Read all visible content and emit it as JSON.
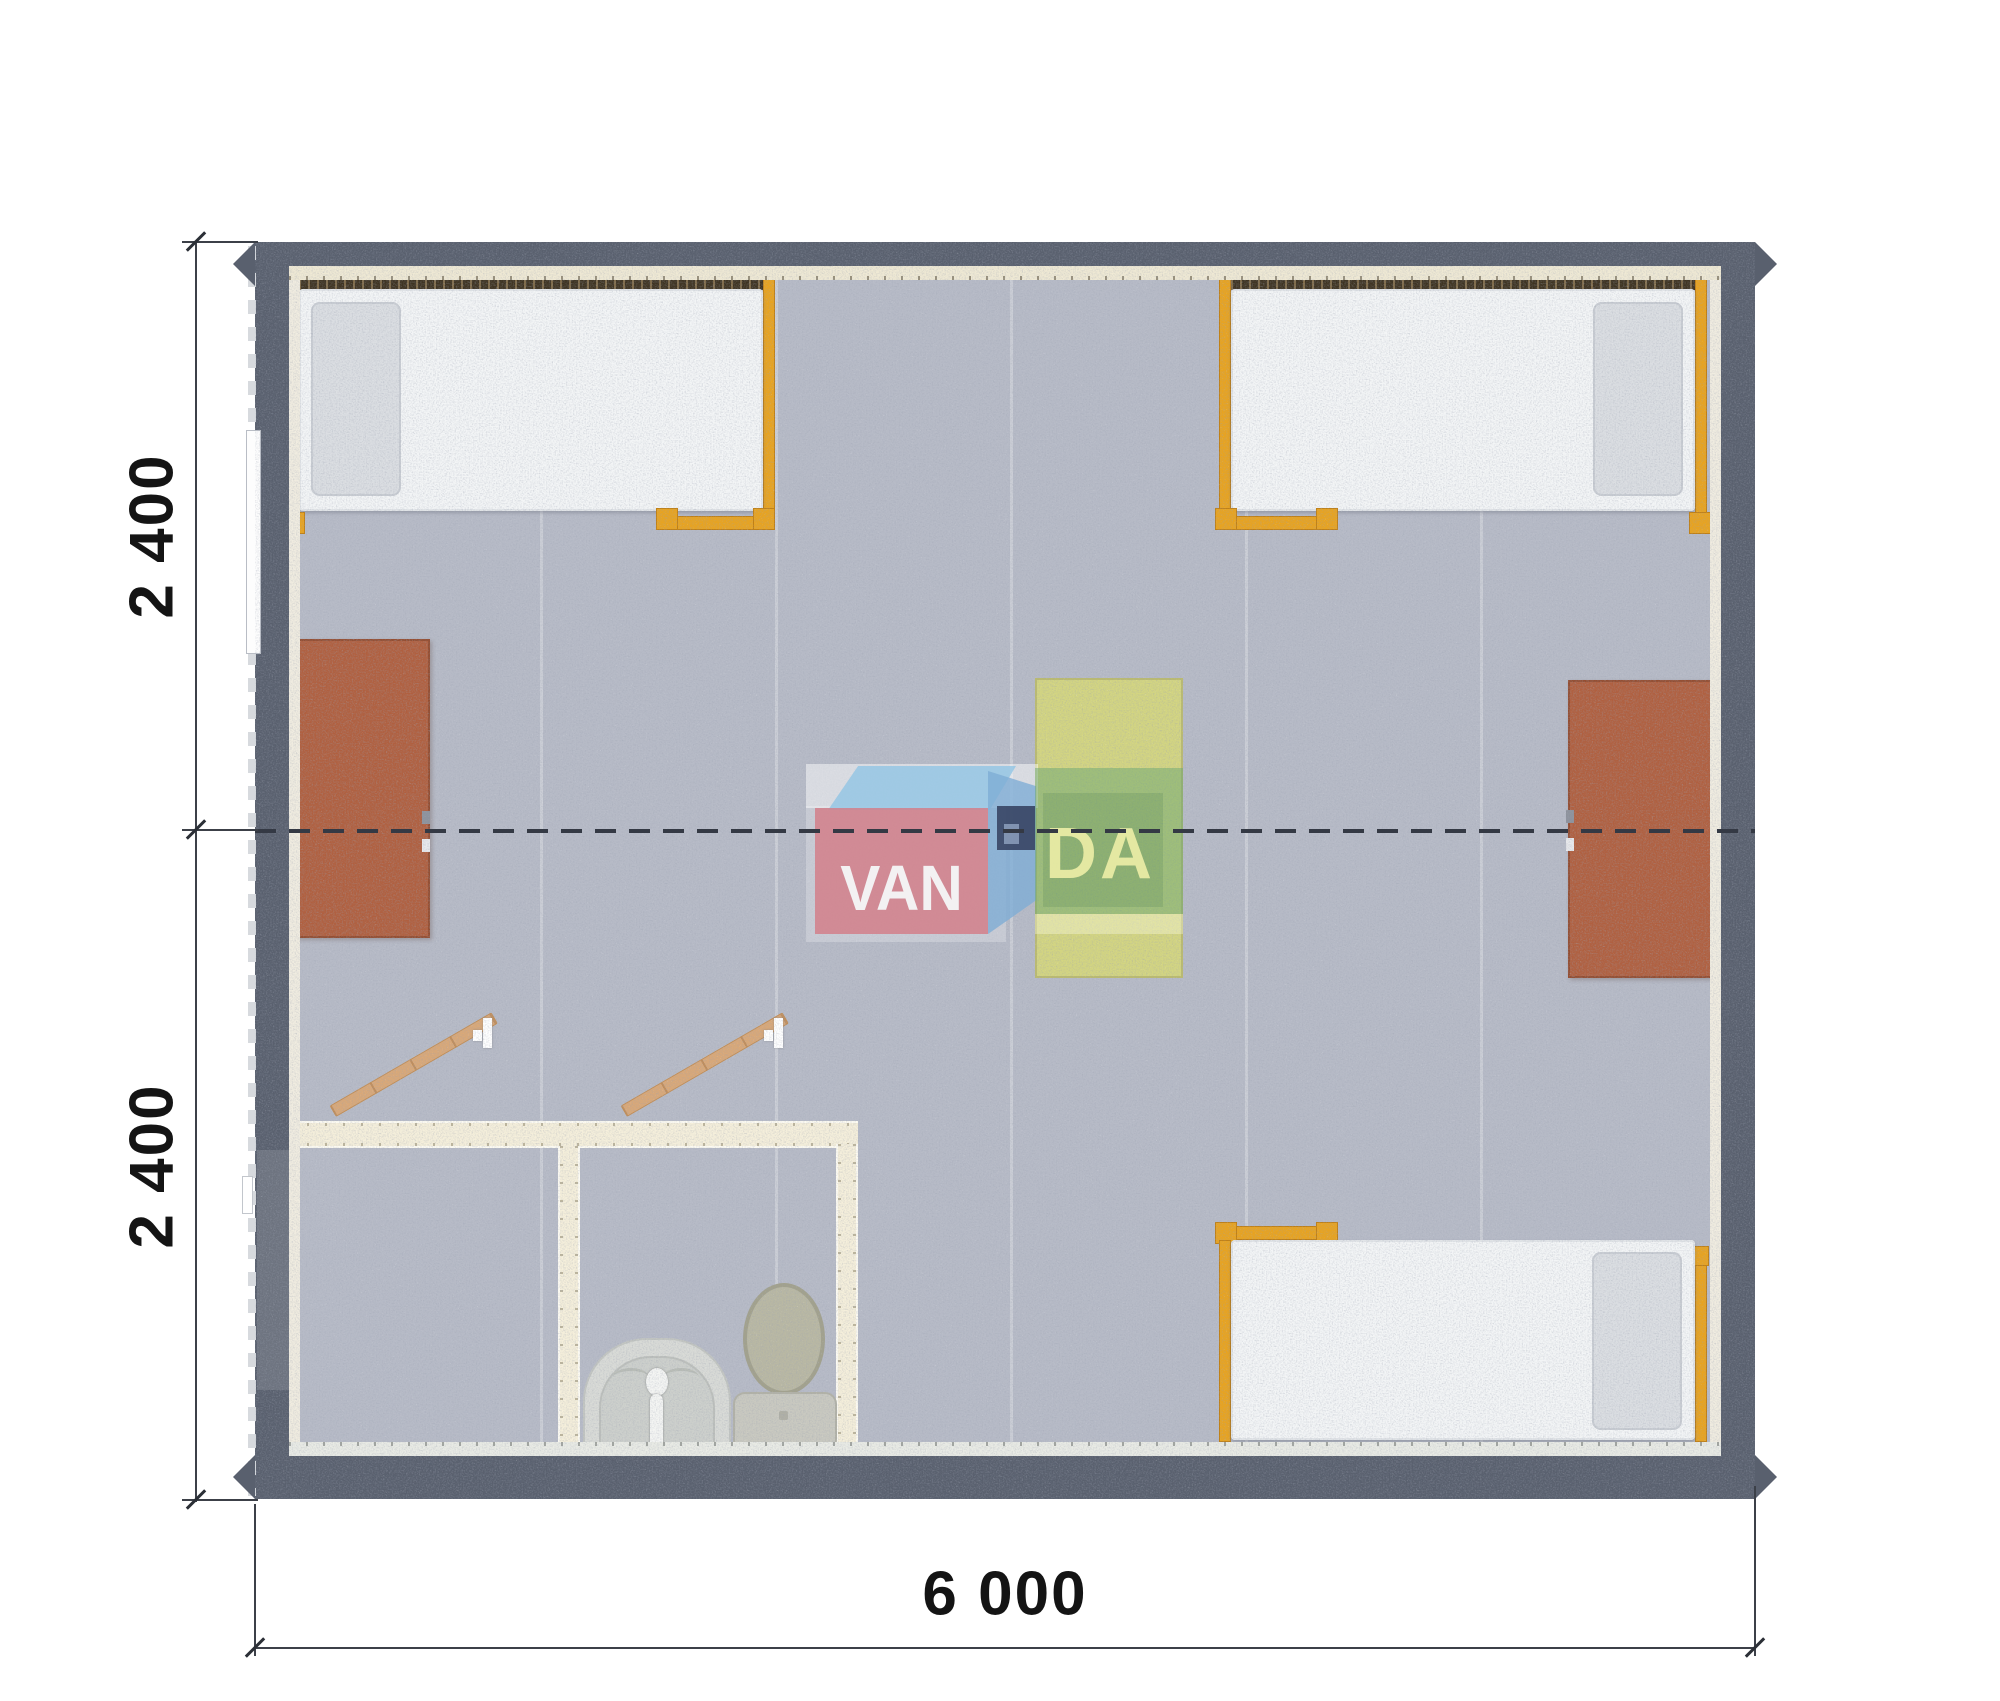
{
  "floorplan": {
    "type": "modular-cabin-top-view",
    "dimensions": {
      "left_top": "2 400",
      "left_bottom": "2 400",
      "bottom": "6 000"
    },
    "watermark": {
      "brand": "VANDA",
      "part_left": "VAN",
      "part_right": "DA"
    },
    "palette": {
      "wall": "#59606e",
      "carpet": "#b7bbc7",
      "wall_lining": "#efe9d4",
      "bed_frame_orange": "#e8a31f",
      "mattress": "#f3f5f6",
      "cabinet_brown": "#b06040",
      "table_yellow": "#d6d87c",
      "bathroom_wall": "#f5efdb",
      "door_wood": "#d9a878",
      "logo_pink": "#d57e88",
      "logo_blue": "#94c7e5",
      "logo_navy": "#384766",
      "logo_green": "#68a674",
      "dimension_text": "#141414"
    },
    "objects": {
      "beds": 3,
      "wardrobe_cabinets": 2,
      "center_table": 1,
      "bathroom_rooms": 2,
      "toilet": 1,
      "washbasin": 1,
      "open_doors": 2,
      "window": 1
    }
  }
}
